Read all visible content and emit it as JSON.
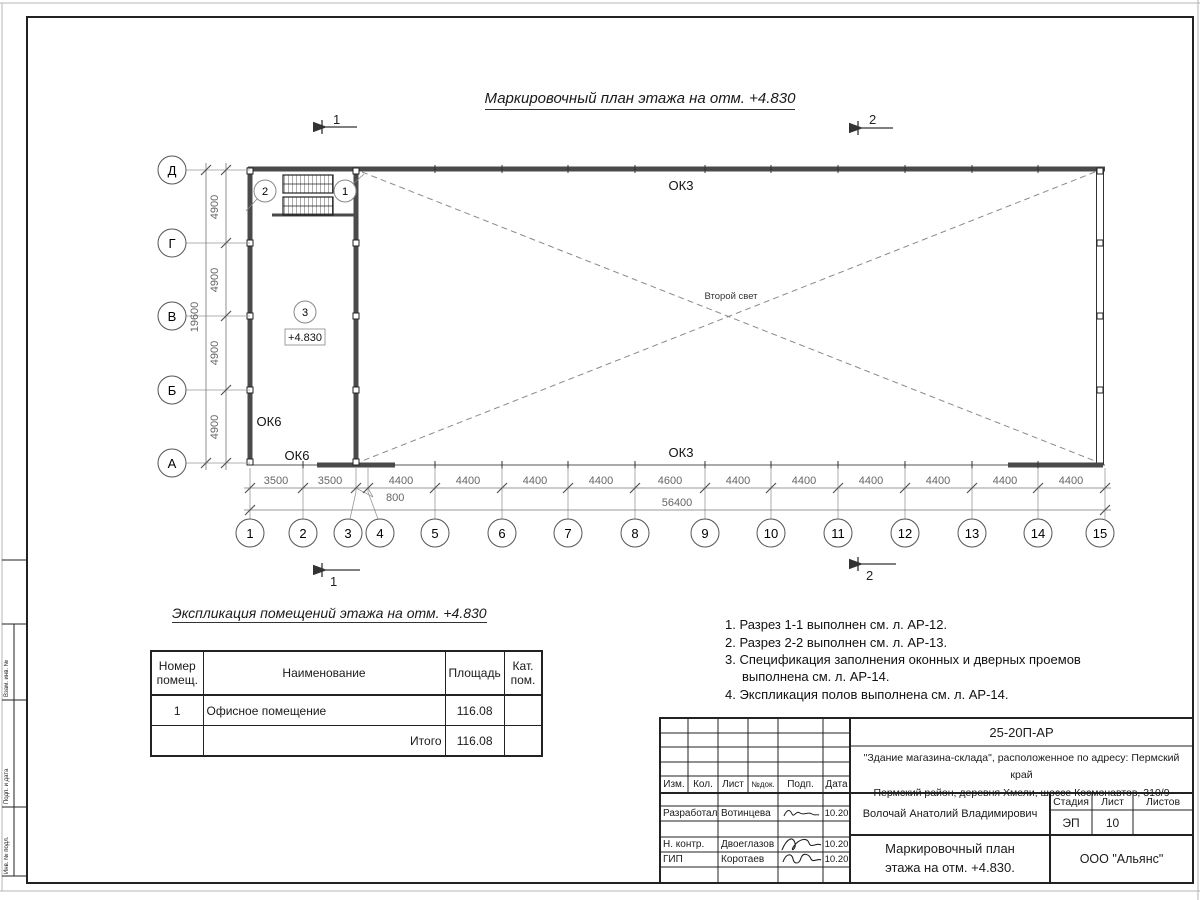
{
  "sheet": {
    "title": "Маркировочный план этажа на отм. +4.830"
  },
  "plan": {
    "row_axes": [
      "Д",
      "Г",
      "В",
      "Б",
      "А"
    ],
    "col_axes": [
      "1",
      "2",
      "3",
      "4",
      "5",
      "6",
      "7",
      "8",
      "9",
      "10",
      "11",
      "12",
      "13",
      "14",
      "15"
    ],
    "row_spans": [
      "4900",
      "4900",
      "4900",
      "4900"
    ],
    "row_total": "19600",
    "col_spans": [
      "3500",
      "3500",
      "4400",
      "4400",
      "4400",
      "4400",
      "4600",
      "4400",
      "4400",
      "4400",
      "4400",
      "4400",
      "4400"
    ],
    "col_offset": "800",
    "col_total": "56400",
    "labels": {
      "ok3_top": "ОК3",
      "ok3_bottom": "ОК3",
      "ok6_upper": "ОК6",
      "ok6_lower": "ОК6",
      "second_light": "Второй свет",
      "elevation": "+4.830"
    },
    "room_marks": [
      "1",
      "2",
      "3"
    ],
    "section_marks": {
      "s1": "1",
      "s2": "2"
    }
  },
  "explication": {
    "title": "Экспликация помещений этажа на отм. +4.830",
    "headers": [
      "Номер помещ.",
      "Наименование",
      "Площадь",
      "Кат. пом."
    ],
    "rows": [
      {
        "num": "1",
        "name": "Офисное помещение",
        "area": "116.08",
        "cat": ""
      }
    ],
    "total_label": "Итого",
    "total_area": "116.08"
  },
  "notes": [
    "1. Разрез 1-1 выполнен см. л. АР-12.",
    "2. Разрез 2-2 выполнен см. л. АР-13.",
    "3. Спецификация заполнения оконных и дверных проемов выполнена см. л. АР-14.",
    "4. Экспликация полов выполнена см. л. АР-14."
  ],
  "titleblock": {
    "doc_number": "25-20П-АР",
    "project_line1": "\"Здание магазина-склада\", расположенное по адресу: Пермский край",
    "project_line2": "Пермский район, деревня Хмели, шоссе Космонавтов, 310/9",
    "header_cols": [
      "Изм.",
      "Кол.",
      "Лист",
      "№док.",
      "Подп.",
      "Дата"
    ],
    "roles": [
      {
        "role": "Разработал",
        "name": "Вотинцева",
        "date": "10.20"
      },
      {
        "role": "Н. контр.",
        "name": "Двоеглазов",
        "date": "10.20"
      },
      {
        "role": "ГИП",
        "name": "Коротаев",
        "date": "10.20"
      }
    ],
    "chief_name": "Волочай Анатолий Владимирович",
    "stage_label": "Стадия",
    "sheet_label": "Лист",
    "sheets_label": "Листов",
    "stage_value": "ЭП",
    "sheet_value": "10",
    "sheets_value": "",
    "drawing_title_line1": "Маркировочный план",
    "drawing_title_line2": "этажа на отм. +4.830.",
    "company": "ООО \"Альянс\""
  },
  "side_strip": {
    "labels": [
      "Взам. инв. №",
      "Подп. и дата",
      "Инв. № подл."
    ]
  }
}
